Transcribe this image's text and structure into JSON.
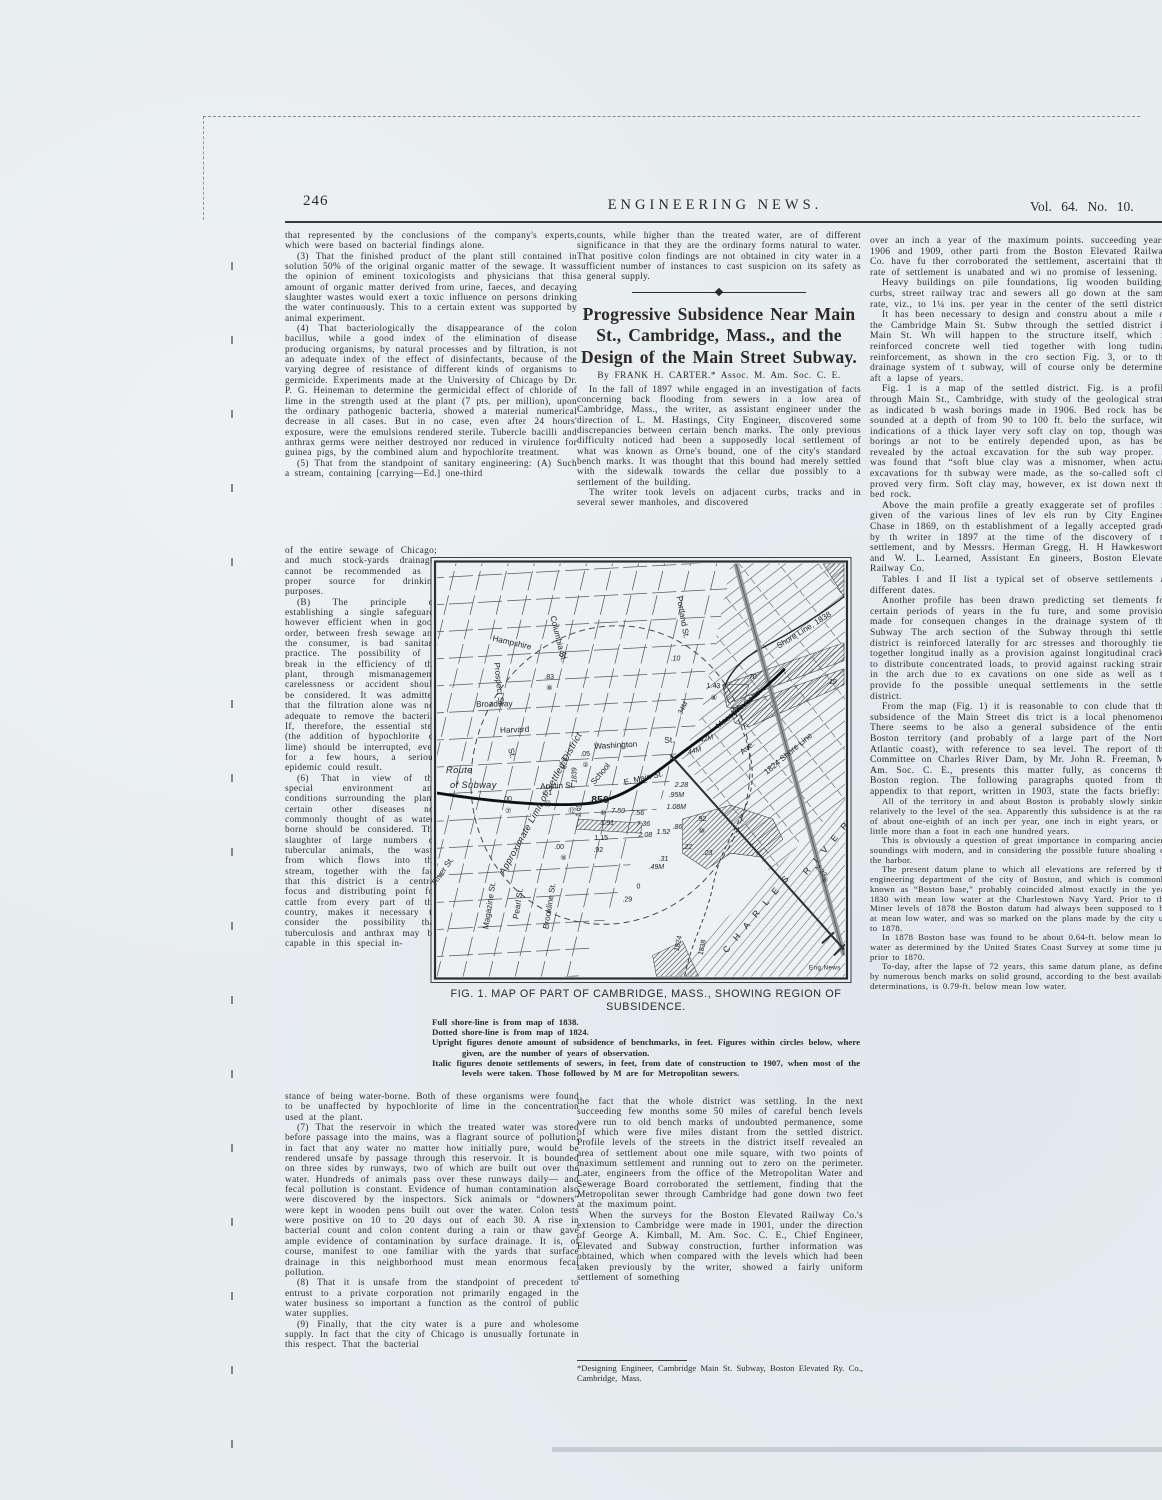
{
  "header": {
    "page_number": "246",
    "journal_title": "ENGINEERING NEWS.",
    "volume": "Vol. 64. No. 10."
  },
  "col1": {
    "top": [
      "that represented by the conclusions of the company's experts, which were based on bacterial findings alone.",
      "(3) That the finished product of the plant still contained in solution 50% of the original organic matter of the sewage. It was the opinion of eminent toxicologists and physicians that this amount of organic matter derived from urine, faeces, and decaying slaughter wastes would exert a toxic influence on persons drinking the water continuously. This to a certain extent was supported by animal experiment.",
      "(4) That bacteriologically the disappearance of the colon bacillus, while a good index of the elimination of disease producing organisms, by natural processes and by filtration, is not an adequate index of the effect of disinfectants, because of the varying degree of resistance of different kinds of organisms to germicide. Experiments made at the University of Chicago by Dr. P. G. Heineman to determine the germicidal effect of chloride of lime in the strength used at the plant (7 pts. per million), upon the ordinary pathogenic bacteria, showed a material numerical decrease in all cases. But in no case, even after 24 hours' exposure, were the emulsions rendered sterile. Tubercle bacilli and anthrax germs were neither destroyed nor reduced in virulence for guinea pigs, by the combined alum and hypochlorite treatment.",
      "(5) That from the standpoint of sanitary engineering: (A) Such a stream, containing [carrying—Ed.] one-third"
    ],
    "narrow": [
      "of the entire sewage of Chicago; and much stock-yards drainage, cannot be recommended as a proper source for drinking purposes.",
      "(B) The principle of establishing a single safeguard, however efficient when in good order, between fresh sewage and the consumer, is bad sanitary practice. The possibility of a break in the efficiency of the plant, through mismanagement, carelessness or accident should be considered. It was admitted that the filtration alone was not adequate to remove the bacteria. If, therefore, the essential step (the addition of hypochlorite of lime) should be interrupted, even for a few hours, a serious epidemic could result.",
      "(6) That in view of the special environment and conditions surrounding the plant, certain other diseases not commonly thought of as water-borne should be considered. The slaughter of large numbers of tubercular animals, the waste from which flows into the stream, together with the fact that this district is a central focus and distributing point for cattle from every part of the country, makes it necessary to consider the possibility that tuberculosis and anthrax may be capable in this special in-"
    ],
    "bottom": [
      "stance of being water-borne. Both of these organisms were found to be unaffected by hypochlorite of lime in the concentration used at the plant.",
      "(7) That the reservoir in which the treated water was stored before passage into the mains, was a flagrant source of pollution; in fact that any water no matter how initially pure, would be rendered unsafe by passage through this reservoir. It is bounded on three sides by runways, two of which are built out over the water. Hundreds of animals pass over these runways daily— and fecal pollution is constant. Evidence of human contamination also were discovered by the inspectors. Sick animals or “downers” were kept in wooden pens built out over the water. Colon tests were positive on 10 to 20 days out of each 30. A rise in bacterial count and colon content during a rain or thaw gave ample evidence of contamination by surface drainage. It is, of course, manifest to one familiar with the yards that surface drainage in this neighborhood must mean enormous fecal pollution.",
      "(8) That it is unsafe from the standpoint of precedent to entrust to a private corporation not primarily engaged in the water business so important a function as the control of public water supplies.",
      "(9) Finally, that the city water is a pure and wholesome supply. In fact that the city of Chicago is unusually fortunate in this respect. That the bacterial"
    ]
  },
  "col2": {
    "top_paragraph": "counts, while higher than the treated water, are of different significance in that they are the ordinary forms natural to water. That positive colon findings are not obtained in city water in a sufficient number of instances to cast suspicion on its safety as a general supply.",
    "article": {
      "title": "Progressive Subsidence Near Main St., Cambridge, Mass., and the Design of the Main Street Subway.",
      "byline": "By FRANK H. CARTER.* Assoc. M. Am. Soc. C. E.",
      "paragraphs": [
        "In the fall of 1897 while engaged in an investigation of facts concerning back flooding from sewers in a low area of Cambridge, Mass., the writer, as assistant engineer under the direction of L. M. Hastings, City Engineer, discovered some discrepancies between certain bench marks. The only previous difficulty noticed had been a supposedly local settlement of what was known as Orne's bound, one of the city's standard bench marks. It was thought that this bound had merely settled with the sidewalk towards the cellar due possibly to a settlement of the building.",
        "The writer took levels on adjacent curbs, tracks and in several sewer manholes, and discovered"
      ]
    },
    "below": [
      "the fact that the whole district was settling. In the next succeeding few months some 50 miles of careful bench levels were run to old bench marks of undoubted permanence, some of which were five miles distant from the settled district. Profile levels of the streets in the district itself revealed an area of settlement about one mile square, with two points of maximum settlement and running out to zero on the perimeter. Later, engineers from the office of the Metropolitan Water and Sewerage Board corroborated the settlement, finding that the Metropolitan sewer through Cambridge had gone down two feet at the maximum point.",
      "When the surveys for the Boston Elevated Railway Co.'s extension to Cambridge were made in 1901, under the direction of George A. Kimball, M. Am. Soc. C. E., Chief Engineer, Elevated and Subway construction, further information was obtained, which when compared with the levels which had been taken previously by the writer, showed a fairly uniform settlement of something"
    ],
    "footnote": "*Designing Engineer, Cambridge Main St. Subway, Boston Elevated Ry. Co., Cambridge, Mass."
  },
  "col3": {
    "paragraphs": [
      "over an inch a year of the maximum points. succeeding years, 1906 and 1909, other parti from the Boston Elevated Railway Co. have fu ther corroborated the settlement, ascertaini that the rate of settlement is unabated and wi no promise of lessening.",
      "Heavy buildings on pile foundations, lig wooden buildings, curbs, street railway trac and sewers all go down at the same rate, viz., to 1¼ ins. per year in the center of the settl district.",
      "It has been necessary to design and constru about a mile of the Cambridge Main St. Subw through the settled district in Main St. Wh will happen to the structure itself, which is reinforced concrete well tied together with long tudinal reinforcement, as shown in the cro section Fig. 3, or to the drainage system of t subway, will of course only be determined aft a lapse of years.",
      "Fig. 1 is a map of the settled district. Fig. is a profile through Main St., Cambridge, with study of the geological strata as indicated b wash borings made in 1906. Bed rock has bee sounded at a depth of from 90 to 100 ft. belo the surface, with indications of a thick layer very soft clay on top, though wash borings ar not to be entirely depended upon, as has bee revealed by the actual excavation for the sub way proper. It was found that “soft blue clay was a misnomer, when actual excavations for th subway were made, as the so-called soft cla proved very firm. Soft clay may, however, ex ist down next the bed rock.",
      "Above the main profile a greatly exaggerate set of profiles is given of the various lines of lev els run by City Engineer Chase in 1869, on th establishment of a legally accepted grade; by th writer in 1897 at the time of the discovery of th settlement, and by Messrs. Herman Gregg, H. H Hawkesworth and W. L. Learned, Assistant En gineers, Boston Elevated Railway Co.",
      "Tables I and II list a typical set of observe settlements at different dates.",
      "Another profile has been drawn predicting set tlements for certain periods of years in the fu ture, and some provision made for consequen changes in the drainage system of the Subway The arch section of the Subway through thi settled district is reinforced laterally for arc stresses and thoroughly tied together longitud inally as a provision against longitudinal cracks to distribute concentrated loads, to provid against racking strains in the arch due to ex cavations on one side as well as to provide fo the possible unequal settlements in the settled district.",
      "From the map (Fig. 1) it is reasonable to con clude that the subsidence of the Main Street dis trict is a local phenomenon. There seems to be also a general subsidence of the entire Boston territory (and probably of a large part of the North Atlantic coast), with reference to sea level. The report of the Committee on Charles River Dam, by Mr. John R. Freeman, M. Am. Soc. C. E., presents this matter fully, as concerns the Boston region. The following paragraphs quoted from the appendix to that report, written in 1903, state the facts briefly:"
    ],
    "quote": [
      "All of the territory in and about Boston is probably slowly sinking relatively to the level of the sea. Apparently this subsidence is at the rate of about one-eighth of an inch per year, one inch in eight years, or a little more than a foot in each one hundred years.",
      "This is obviously a question of great importance in comparing ancient soundings with modern, and in considering the possible future shoaling of the harbor.",
      "The present datum plane to which all elevations are referred by the engineering department of the city of Boston, and which is commonly known as “Boston base,” probably coincided almost exactly in the year 1830 with mean low water at the Charlestown Navy Yard. Prior to the Miner levels of 1878 the Boston datum had always been supposed to be at mean low water, and was so marked on the plans made by the city up to 1878.",
      "In 1878 Boston base was found to be about 0.64-ft. below mean low water as determined by the United States Coast Survey at some time just prior to 1870.",
      "To-day, after the lapse of 72 years, this same datum plane, as defined by numerous bench marks on solid ground, according to the best available determinations, is 0.79-ft. below mean low water."
    ]
  },
  "figure": {
    "caption_title": "FIG. 1. MAP OF PART OF CAMBRIDGE, MASS., SHOWING REGION OF SUBSIDENCE.",
    "notes": [
      "Full shore-line is from map of 1838.",
      "Dotted shore-line is from map of 1824.",
      "Upright figures denote amount of subsidence of benchmarks, in feet. Figures within circles below, where given, are the number of years of observation.",
      "Italic figures denote settlements of sewers, in feet, from date of construction to 1907, when most of the levels were taken. Those followed by M are for Metropolitan sewers."
    ],
    "map_texts": [
      {
        "t": "Hampshire",
        "x": 62,
        "y": 84,
        "r": 13,
        "s": "st"
      },
      {
        "t": "St.",
        "x": 128,
        "y": 99,
        "r": 13,
        "s": "st"
      },
      {
        "t": "Columbia St.",
        "x": 120,
        "y": 60,
        "r": 76,
        "s": "st"
      },
      {
        "t": "Portland St.",
        "x": 246,
        "y": 40,
        "r": 80,
        "s": "st"
      },
      {
        "t": "Prospect St.",
        "x": 64,
        "y": 106,
        "r": 84,
        "s": "st"
      },
      {
        "t": "Broadway",
        "x": 46,
        "y": 150,
        "r": -1,
        "s": "st"
      },
      {
        "t": "Harvard",
        "x": 70,
        "y": 176,
        "r": -2,
        "s": "st"
      },
      {
        "t": "St.",
        "x": 78,
        "y": 192,
        "r": 76,
        "s": "st"
      },
      {
        "t": "Washington",
        "x": 164,
        "y": 192,
        "r": -3,
        "s": "st"
      },
      {
        "t": "St.",
        "x": 234,
        "y": 186,
        "r": -3,
        "s": "st"
      },
      {
        "t": "Austin St.",
        "x": 110,
        "y": 232,
        "r": -2,
        "s": "st"
      },
      {
        "t": "School",
        "x": 164,
        "y": 228,
        "r": -50,
        "s": "st"
      },
      {
        "t": "E. Main St.",
        "x": 194,
        "y": 228,
        "r": -13,
        "s": "st"
      },
      {
        "t": "Massachusetts",
        "x": 288,
        "y": 172,
        "r": -40,
        "s": "st"
      },
      {
        "t": "Ave.",
        "x": 312,
        "y": 198,
        "r": -40,
        "s": "st"
      },
      {
        "t": "River St.",
        "x": 6,
        "y": 328,
        "r": -55,
        "s": "st"
      },
      {
        "t": "Magazine St.",
        "x": 58,
        "y": 372,
        "r": -81,
        "s": "st"
      },
      {
        "t": "Pearl St.",
        "x": 88,
        "y": 362,
        "r": -81,
        "s": "st"
      },
      {
        "t": "Brookline St.",
        "x": 118,
        "y": 372,
        "r": -81,
        "s": "st"
      },
      {
        "t": "C H A R L E S",
        "x": 296,
        "y": 396,
        "r": -50,
        "s": "sp"
      },
      {
        "t": "R I V E R",
        "x": 376,
        "y": 318,
        "r": -50,
        "s": "sp"
      },
      {
        "t": "Shore Line, 1838",
        "x": 348,
        "y": 92,
        "r": -32,
        "s": "st"
      },
      {
        "t": "1824 Shore Line",
        "x": 336,
        "y": 218,
        "r": -40,
        "s": "st"
      },
      {
        "t": "Route",
        "x": 16,
        "y": 216,
        "s": "scr"
      },
      {
        "t": "of Subway",
        "x": 20,
        "y": 231,
        "s": "scr"
      },
      {
        "t": "Approximate Limit of Settled District",
        "x": 74,
        "y": 318,
        "r": -61,
        "s": "scr"
      },
      {
        "t": "Eng.News",
        "x": 378,
        "y": 412,
        "s": "tiny"
      },
      {
        "t": ".83",
        "x": 114,
        "y": 122,
        "s": "ann"
      },
      {
        "t": "⑧",
        "x": 116,
        "y": 133,
        "s": "ann"
      },
      {
        "t": "1.43",
        "x": 276,
        "y": 131,
        "s": "ann"
      },
      {
        "t": "⑧",
        "x": 280,
        "y": 143,
        "s": "ann"
      },
      {
        "t": ".70",
        "x": 316,
        "y": 122,
        "s": "ann",
        "i": 1
      },
      {
        "t": ".19",
        "x": 396,
        "y": 127,
        "s": "ann",
        "i": 1
      },
      {
        "t": ".10",
        "x": 240,
        "y": 104,
        "s": "ann",
        "i": 1
      },
      {
        "t": ".05",
        "x": 150,
        "y": 199,
        "s": "ann"
      },
      {
        "t": "②",
        "x": 152,
        "y": 210,
        "s": "ann"
      },
      {
        "t": ".51",
        "x": 112,
        "y": 238,
        "s": "ann"
      },
      {
        "t": "⑱",
        "x": 114,
        "y": 249,
        "s": "ann"
      },
      {
        "t": ".00",
        "x": 72,
        "y": 244,
        "s": "ann"
      },
      {
        "t": "⑦",
        "x": 75,
        "y": 256,
        "s": "ann"
      },
      {
        "t": ".850",
        "x": 158,
        "y": 246,
        "s": "lg"
      },
      {
        "t": "1.69",
        "x": 150,
        "y": 260,
        "r": -90,
        "s": "ann",
        "i": 1
      },
      {
        "t": "⑫",
        "x": 138,
        "y": 256,
        "s": "ann"
      },
      {
        "t": "⑩",
        "x": 170,
        "y": 258,
        "s": "ann"
      },
      {
        "t": "7.50",
        "x": 181,
        "y": 256,
        "s": "ann",
        "i": 1
      },
      {
        "t": "1.91",
        "x": 170,
        "y": 268,
        "s": "ann",
        "i": 1
      },
      {
        "t": "1.15",
        "x": 164,
        "y": 283,
        "s": "ann"
      },
      {
        "t": ".92",
        "x": 163,
        "y": 295,
        "s": "ann"
      },
      {
        "t": ".00",
        "x": 124,
        "y": 292,
        "s": "ann"
      },
      {
        "t": "⑨",
        "x": 130,
        "y": 303,
        "s": "ann"
      },
      {
        "t": "2.08",
        "x": 208,
        "y": 280,
        "s": "ann",
        "i": 1
      },
      {
        "t": "1.52",
        "x": 226,
        "y": 277,
        "s": "ann",
        "i": 1
      },
      {
        "t": ".86",
        "x": 242,
        "y": 272,
        "s": "ann",
        "i": 1
      },
      {
        "t": "7.36",
        "x": 206,
        "y": 269,
        "s": "ann",
        "i": 1
      },
      {
        "t": "7.56",
        "x": 200,
        "y": 258,
        "s": "ann",
        "i": 1
      },
      {
        "t": ".95M",
        "x": 238,
        "y": 240,
        "s": "ann",
        "i": 1
      },
      {
        "t": "1.08M",
        "x": 236,
        "y": 252,
        "s": "ann",
        "i": 1
      },
      {
        "t": "2.28",
        "x": 244,
        "y": 230,
        "s": "ann",
        "i": 1
      },
      {
        "t": ".92",
        "x": 266,
        "y": 264,
        "s": "ann"
      },
      {
        "t": "⑩",
        "x": 268,
        "y": 276,
        "s": "ann"
      },
      {
        "t": ".34M",
        "x": 250,
        "y": 160,
        "r": -62,
        "s": "ann",
        "i": 1
      },
      {
        "t": ".42M",
        "x": 268,
        "y": 186,
        "r": -15,
        "s": "ann",
        "i": 1
      },
      {
        "t": ".44M",
        "x": 256,
        "y": 198,
        "r": -15,
        "s": "ann",
        "i": 1
      },
      {
        "t": ".49M",
        "x": 218,
        "y": 312,
        "s": "ann",
        "i": 1
      },
      {
        "t": ".29",
        "x": 192,
        "y": 344,
        "s": "ann"
      },
      {
        "t": "0",
        "x": 206,
        "y": 331,
        "s": "ann"
      },
      {
        "t": "2.33",
        "x": 384,
        "y": 310,
        "r": 48,
        "s": "ann"
      },
      {
        "t": "⑧",
        "x": 390,
        "y": 322,
        "r": 48,
        "s": "ann"
      },
      {
        "t": "1824",
        "x": 248,
        "y": 394,
        "r": -78,
        "s": "ann"
      },
      {
        "t": "1838",
        "x": 272,
        "y": 398,
        "r": -78,
        "s": "ann"
      },
      {
        "t": "1839",
        "x": 146,
        "y": 226,
        "r": -90,
        "s": "ann",
        "i": 1
      },
      {
        "t": "626",
        "x": 136,
        "y": 212,
        "r": -90,
        "s": "ann",
        "i": 1
      },
      {
        "t": ".22",
        "x": 252,
        "y": 292,
        "s": "ann",
        "i": 1
      },
      {
        "t": ".31",
        "x": 228,
        "y": 304,
        "s": "ann",
        "i": 1
      },
      {
        "t": ".23",
        "x": 272,
        "y": 298,
        "s": "ann",
        "i": 1
      }
    ]
  }
}
